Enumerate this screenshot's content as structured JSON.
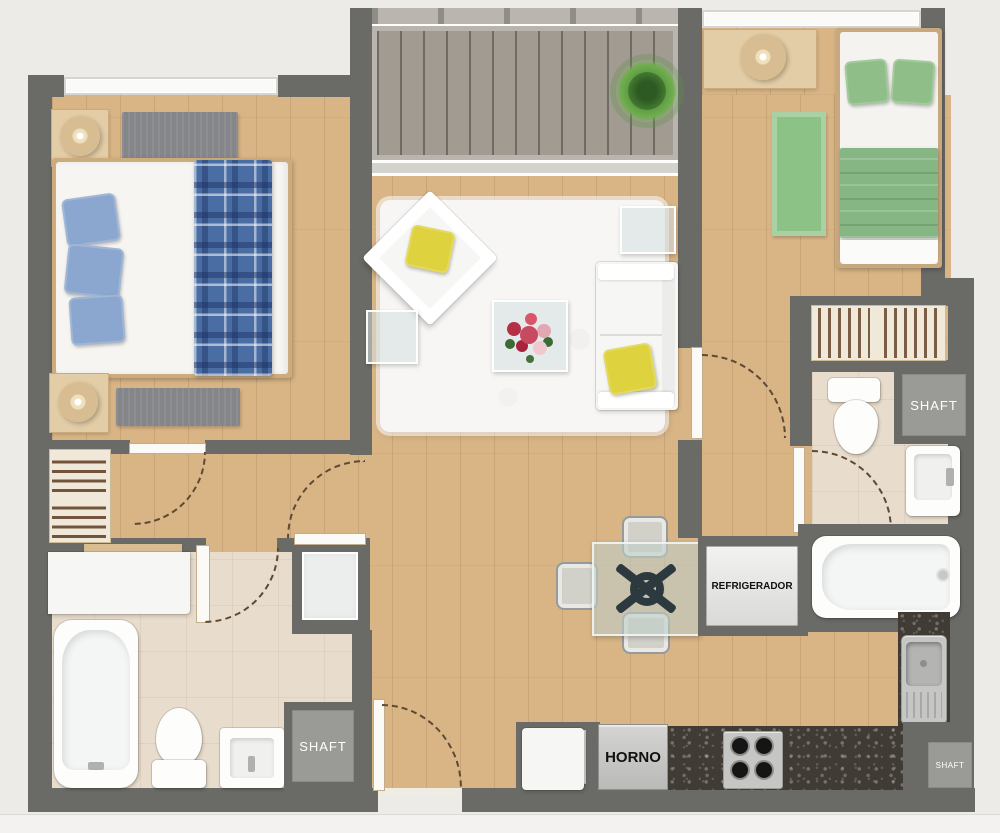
{
  "scene": {
    "type": "apartment floor plan, top-down render"
  },
  "labels": {
    "shafts": [
      "SHAFT",
      "SHAFT",
      "SHAFT"
    ],
    "refrigerator": "REFRIGERADOR",
    "oven": "HORNO"
  },
  "colors": {
    "wall": "#6a6a67",
    "wood": "#d9b586",
    "deck": "#a19b92",
    "tile": "#e8dccc",
    "granite": "#403c35",
    "rug_white": "#f7f6f4",
    "rug_gray": "#85868a",
    "rug_green": "#8cc285",
    "pillow_blue": "#8ba6cf",
    "pillow_green": "#8fbe88",
    "pillow_yellow": "#ded23e",
    "blanket_blue": "#4a6da3",
    "blanket_green": "#85b683",
    "plant_green": "#4e8a38",
    "label_dark": "#111111",
    "label_light": "#ffffff"
  }
}
